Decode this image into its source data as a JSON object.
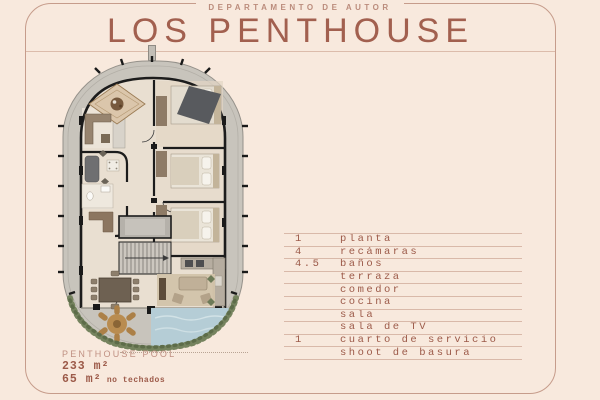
{
  "header": {
    "kicker": "DEPARTAMENTO DE AUTOR",
    "title": "LOS PENTHOUSE"
  },
  "features": {
    "rows": [
      {
        "qty": "1",
        "label": "planta"
      },
      {
        "qty": "4",
        "label": "recámaras"
      },
      {
        "qty": "4.5",
        "label": "baños"
      },
      {
        "qty": "",
        "label": "terraza"
      },
      {
        "qty": "",
        "label": "comedor"
      },
      {
        "qty": "",
        "label": "cocina"
      },
      {
        "qty": "",
        "label": "sala"
      },
      {
        "qty": "",
        "label": "sala de TV"
      },
      {
        "qty": "1",
        "label": "cuarto de servicio"
      },
      {
        "qty": "",
        "label": "shoot de basura"
      }
    ]
  },
  "footer": {
    "plan_name": "PENTHOUSE POOL",
    "area_total": "233 m²",
    "area_open_value": "65 m²",
    "area_open_note": " no techados"
  },
  "colors": {
    "background": "#f8e9dd",
    "accent": "#a2604f",
    "list_text": "#9c5a49",
    "muted_label": "#c09183",
    "rule_line": "#d9b9a9",
    "card_border": "#c69c8b",
    "plan_deck": "#c8c4bc",
    "plan_floor": "#e9dfd1",
    "plan_wall": "#1c1c1c",
    "pool": "#b5cdd6",
    "greenery": "#75835e",
    "furniture_brown": "#8c7660"
  }
}
